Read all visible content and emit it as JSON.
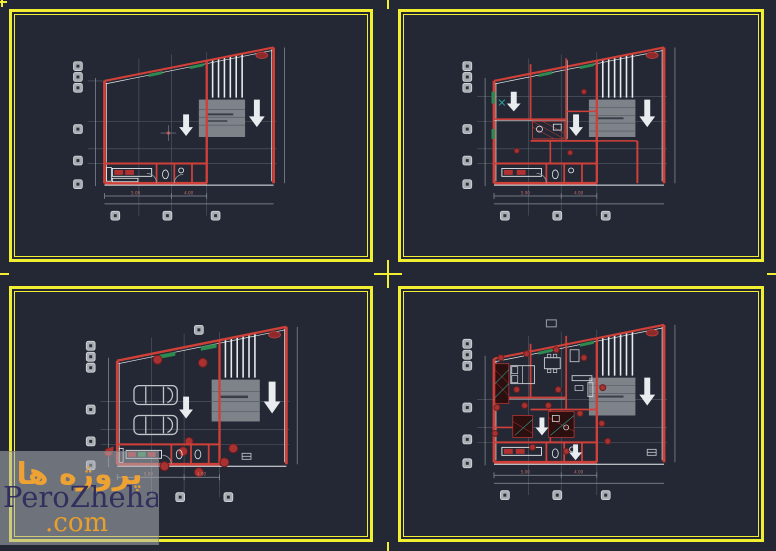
{
  "watermark": {
    "brand_farsi": "پروژه ها",
    "brand_latin": "PeroZheha",
    "brand_tld": ".com"
  },
  "colors": {
    "background": "#232834",
    "frame_yellow": "#f2ef30",
    "wall_red": "#d04038",
    "detail_gray": "#9aa0a8",
    "white_lines": "#e9ecef",
    "stair_hatch_gray": "#7e838a",
    "accent_green": "#2e8b4f",
    "symbol_dot_red": "#a83232",
    "watermark_orange": "#eda233",
    "watermark_navy": "#312f5e"
  },
  "sheets": [
    {
      "position": "top-left",
      "type": "basement-plan",
      "dims": {
        "a": "5.00",
        "b": "4.00"
      }
    },
    {
      "position": "top-right",
      "type": "ground-floor-plan",
      "dims": {
        "a": "5.00",
        "b": "4.00"
      }
    },
    {
      "position": "bottom-left",
      "type": "parking-site-plan",
      "dims": {
        "a": "5.00",
        "b": "4.00"
      }
    },
    {
      "position": "bottom-right",
      "type": "furnished-floor-plan",
      "dims": {
        "a": "5.00",
        "b": "4.00"
      }
    }
  ]
}
